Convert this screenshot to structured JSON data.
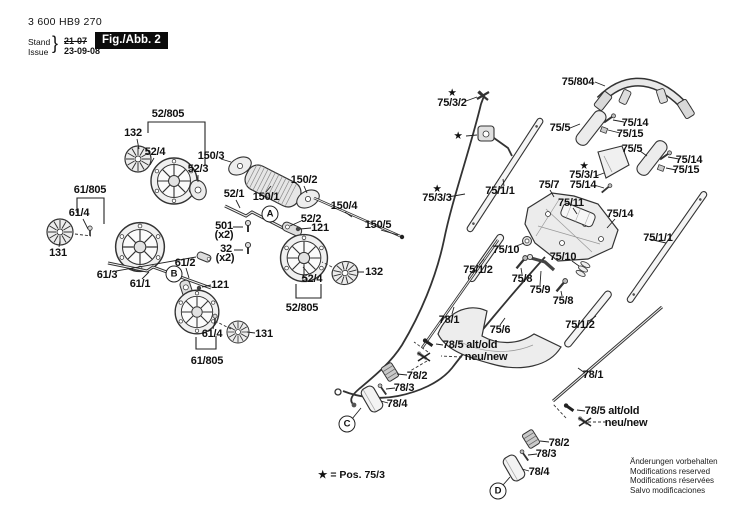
{
  "header": {
    "part_number": "3 600 HB9 270",
    "stand_label": "Stand",
    "issue_label": "Issue",
    "brace": "}",
    "old_date": "21-07",
    "new_date": "23-09-08",
    "figure_label": "Fig./Abb. 2"
  },
  "footnote": {
    "text": "★ = Pos. 75/3"
  },
  "footer": {
    "lines": [
      "Änderungen vorbehalten",
      "Modifications reserved",
      "Modifications réservées",
      "Salvo modificaciones"
    ]
  },
  "colors": {
    "ink": "#111111",
    "line": "#333333",
    "part_fill": "#ededed",
    "fig_box_bg": "#0b0b0b",
    "fig_box_text": "#ffffff"
  },
  "markers": [
    {
      "t": "A",
      "x": 270,
      "y": 214
    },
    {
      "t": "B",
      "x": 174,
      "y": 274
    },
    {
      "t": "C",
      "x": 347,
      "y": 424
    },
    {
      "t": "D",
      "x": 498,
      "y": 491
    }
  ],
  "labels": [
    {
      "t": "52/805",
      "x": 168,
      "y": 114
    },
    {
      "t": "132",
      "x": 133,
      "y": 133
    },
    {
      "t": "52/4",
      "x": 155,
      "y": 152
    },
    {
      "t": "150/3",
      "x": 211,
      "y": 156
    },
    {
      "t": "52/3",
      "x": 198,
      "y": 169
    },
    {
      "t": "150/1",
      "x": 266,
      "y": 197
    },
    {
      "t": "150/2",
      "x": 304,
      "y": 180
    },
    {
      "t": "52/1",
      "x": 234,
      "y": 194
    },
    {
      "t": "150/4",
      "x": 344,
      "y": 206
    },
    {
      "t": "150/5",
      "x": 378,
      "y": 225
    },
    {
      "t": "501",
      "x": 224,
      "y": 226
    },
    {
      "t": "(x2)",
      "x": 224,
      "y": 235
    },
    {
      "t": "32",
      "x": 226,
      "y": 249
    },
    {
      "t": "(x2)",
      "x": 225,
      "y": 258
    },
    {
      "t": "52/2",
      "x": 311,
      "y": 219
    },
    {
      "t": "121",
      "x": 320,
      "y": 228
    },
    {
      "t": "132",
      "x": 374,
      "y": 272
    },
    {
      "t": "52/4",
      "x": 312,
      "y": 279
    },
    {
      "t": "52/805",
      "x": 302,
      "y": 308
    },
    {
      "t": "61/805",
      "x": 90,
      "y": 190
    },
    {
      "t": "61/4",
      "x": 79,
      "y": 213
    },
    {
      "t": "131",
      "x": 58,
      "y": 253
    },
    {
      "t": "61/3",
      "x": 107,
      "y": 275
    },
    {
      "t": "61/1",
      "x": 140,
      "y": 284
    },
    {
      "t": "61/2",
      "x": 185,
      "y": 263
    },
    {
      "t": "121",
      "x": 220,
      "y": 285
    },
    {
      "t": "61/4",
      "x": 212,
      "y": 334
    },
    {
      "t": "131",
      "x": 264,
      "y": 334
    },
    {
      "t": "61/805",
      "x": 207,
      "y": 361
    },
    {
      "t": "★",
      "x": 452,
      "y": 93,
      "cls": "star"
    },
    {
      "t": "75/3/2",
      "x": 452,
      "y": 103
    },
    {
      "t": "★",
      "x": 458,
      "y": 136,
      "cls": "star"
    },
    {
      "t": "75/804",
      "x": 578,
      "y": 82
    },
    {
      "t": "75/5",
      "x": 560,
      "y": 128
    },
    {
      "t": "75/14",
      "x": 635,
      "y": 123
    },
    {
      "t": "75/15",
      "x": 630,
      "y": 134
    },
    {
      "t": "75/5",
      "x": 632,
      "y": 149
    },
    {
      "t": "75/14",
      "x": 689,
      "y": 160
    },
    {
      "t": "75/15",
      "x": 686,
      "y": 170
    },
    {
      "t": "★",
      "x": 584,
      "y": 166,
      "cls": "star"
    },
    {
      "t": "75/3/1",
      "x": 584,
      "y": 175
    },
    {
      "t": "75/14",
      "x": 583,
      "y": 185
    },
    {
      "t": "★",
      "x": 437,
      "y": 189,
      "cls": "star"
    },
    {
      "t": "75/3/3",
      "x": 437,
      "y": 198
    },
    {
      "t": "75/1/1",
      "x": 500,
      "y": 191
    },
    {
      "t": "75/7",
      "x": 549,
      "y": 185
    },
    {
      "t": "75/11",
      "x": 571,
      "y": 203
    },
    {
      "t": "75/14",
      "x": 620,
      "y": 214
    },
    {
      "t": "75/1/1",
      "x": 658,
      "y": 238
    },
    {
      "t": "75/10",
      "x": 506,
      "y": 250
    },
    {
      "t": "75/10",
      "x": 563,
      "y": 257
    },
    {
      "t": "75/1/2",
      "x": 478,
      "y": 270
    },
    {
      "t": "75/8",
      "x": 522,
      "y": 279
    },
    {
      "t": "75/9",
      "x": 540,
      "y": 290
    },
    {
      "t": "75/8",
      "x": 563,
      "y": 301
    },
    {
      "t": "75/1/2",
      "x": 580,
      "y": 325
    },
    {
      "t": "78/1",
      "x": 449,
      "y": 320
    },
    {
      "t": "75/6",
      "x": 500,
      "y": 330
    },
    {
      "t": "78/5 alt/old",
      "x": 470,
      "y": 345
    },
    {
      "t": "neu/new",
      "x": 486,
      "y": 357
    },
    {
      "t": "78/2",
      "x": 417,
      "y": 376
    },
    {
      "t": "78/3",
      "x": 404,
      "y": 388
    },
    {
      "t": "78/4",
      "x": 397,
      "y": 404
    },
    {
      "t": "78/1",
      "x": 593,
      "y": 375
    },
    {
      "t": "78/5 alt/old",
      "x": 612,
      "y": 411
    },
    {
      "t": "neu/new",
      "x": 626,
      "y": 423
    },
    {
      "t": "78/2",
      "x": 559,
      "y": 443
    },
    {
      "t": "78/3",
      "x": 546,
      "y": 454
    },
    {
      "t": "78/4",
      "x": 539,
      "y": 472
    }
  ]
}
